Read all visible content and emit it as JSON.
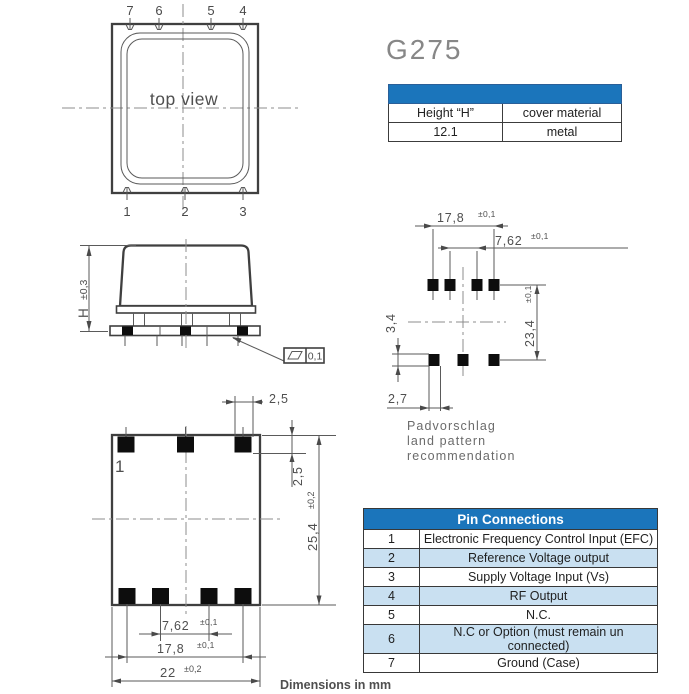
{
  "title": "G275",
  "footer": "Dimensions in mm",
  "colors": {
    "accent_blue": "#1b75bb",
    "row_alt": "#c9e0f1",
    "line_color": "#3f3f3f",
    "dim_text": "#4f4f4f"
  },
  "height_table": {
    "col1_header": "Height “H”",
    "col2_header": "cover material",
    "col1_value": "12.1",
    "col2_value": "metal"
  },
  "pin_table": {
    "title": "Pin Connections",
    "rows": [
      {
        "pin": "1",
        "function": "Electronic Frequency Control Input (EFC)"
      },
      {
        "pin": "2",
        "function": "Reference Voltage output"
      },
      {
        "pin": "3",
        "function": "Supply Voltage Input (Vs)"
      },
      {
        "pin": "4",
        "function": "RF Output"
      },
      {
        "pin": "5",
        "function": "N.C."
      },
      {
        "pin": "6",
        "function": "N.C or Option (must remain un connected)"
      },
      {
        "pin": "7",
        "function": "Ground (Case)"
      }
    ]
  },
  "top_view": {
    "label": "top view",
    "pins_top": [
      "7",
      "6",
      "5",
      "4"
    ],
    "pins_bottom": [
      "1",
      "2",
      "3"
    ]
  },
  "side_view": {
    "height_label": "H",
    "height_tol": "±0,3",
    "flatness": "0,1"
  },
  "land_pattern": {
    "caption": [
      "Padvorschlag",
      "land pattern",
      "recommendation"
    ],
    "dim_outer": "17,8",
    "dim_outer_tol": "±0,1",
    "dim_inner": "7,62",
    "dim_inner_tol": "±0,1",
    "dim_pad_h": "3,4",
    "dim_rows": "23,4",
    "dim_rows_tol": "±0,1",
    "dim_pad_w": "2,7"
  },
  "bottom_view": {
    "pin1": "1",
    "dim_pad_w": "2,5",
    "dim_pad_h": "2,5",
    "dim_height": "25,4",
    "dim_height_tol": "±0,2",
    "dim_inner": "7,62",
    "dim_inner_tol": "±0,1",
    "dim_outer": "17,8",
    "dim_outer_tol": "±0,1",
    "dim_width": "22",
    "dim_width_tol": "±0,2"
  }
}
